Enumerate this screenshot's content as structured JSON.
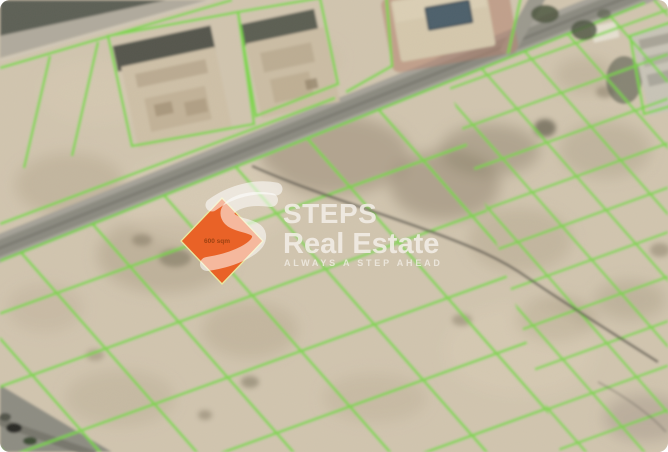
{
  "image": {
    "kind": "satellite-plot-map"
  },
  "watermark": {
    "brand_top": "STEPS",
    "brand_bottom": "Real Estate",
    "tagline": "ALWAYS A STEP AHEAD"
  },
  "highlighted_plot": {
    "label": "600 sqm"
  },
  "colors": {
    "terrain": "#d2c6b0",
    "plot_line": "#77d944",
    "highlight_orange": "#e96227",
    "diamond_border": "#e9e8a0",
    "road": "#9c9a90",
    "road_dark": "#5d6157",
    "pool": "#44545f",
    "watermark_text": "#f2eee7",
    "track": "#4f4b43"
  }
}
